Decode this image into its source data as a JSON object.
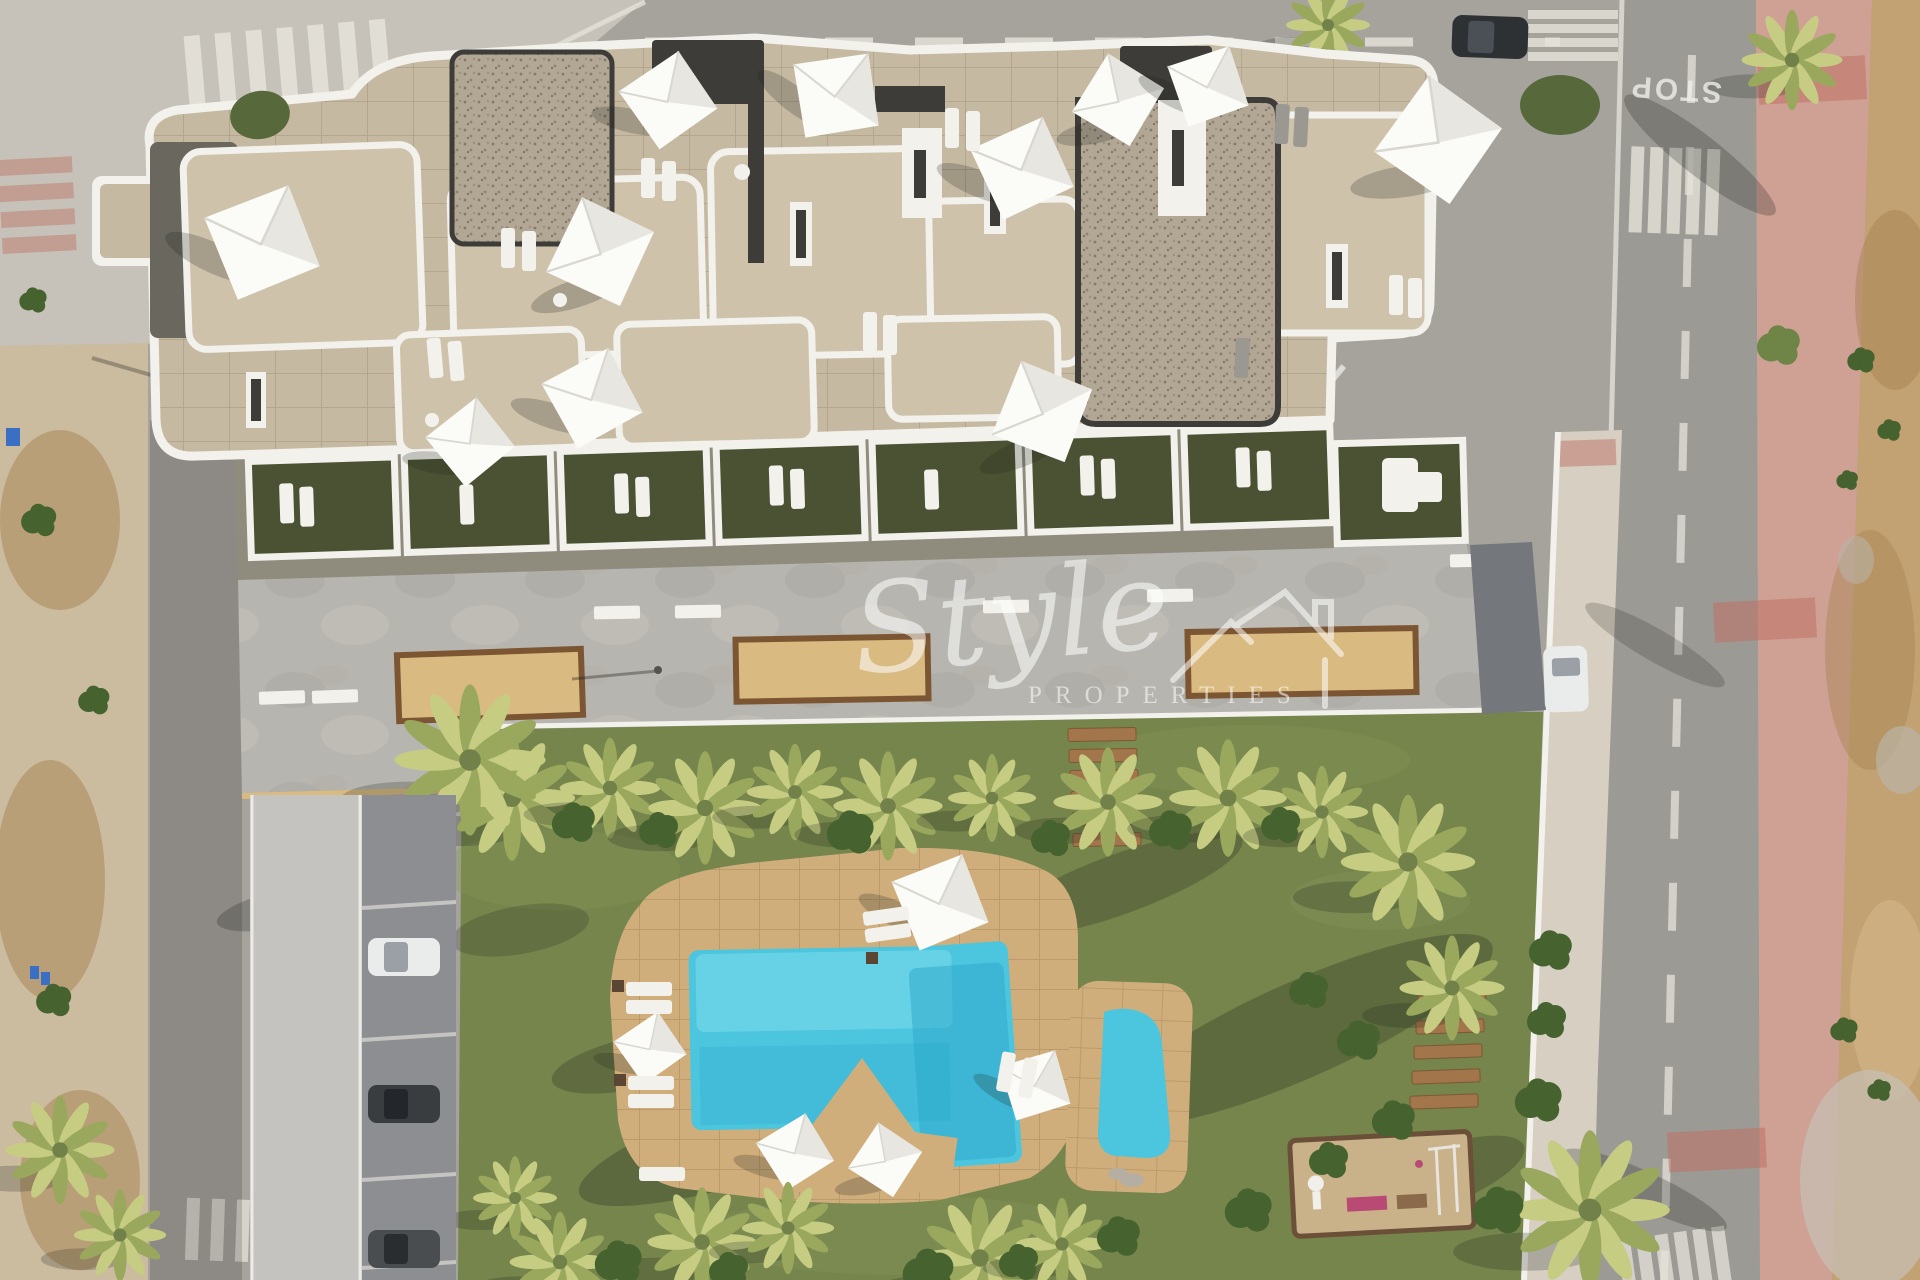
{
  "watermark": {
    "brand_script": "Style",
    "brand_caps": "PROPERTIES"
  },
  "roads": {
    "stop_marking": "STOP"
  },
  "palette": {
    "road": "#a6a39d",
    "pave": "#c6c2b9",
    "road2": "#9c9a94",
    "walk": "#cbbb9f",
    "pink": "#cfa195",
    "red": "#bf7265",
    "dirt": "#c2a173",
    "dirtd": "#a8844f",
    "lawn": "#75854b",
    "lawnl": "#87975c",
    "gdark": "#4b5233",
    "conc": "#b7b5af",
    "conc2": "#c4c3bf",
    "stone": "#c6b9a2",
    "terr": "#cec2ab",
    "grav": "#b2a794",
    "dark": "#3e3c38",
    "white": "#f2f1ec",
    "psand": "#d9ba80",
    "pbord": "#7c5633",
    "deck": "#cfae7c",
    "water": "#4cc5de",
    "waterl": "#82e0ee",
    "waterd": "#2ba8ca",
    "wood": "#a3754a",
    "sand": "#c9b28a",
    "sandb": "#6b4f38",
    "pink2": "#b84a74",
    "cardark": "#3a3d40",
    "carwhite": "#eaebeb",
    "frond": "#c6cd83",
    "frondd": "#9aa85e",
    "hedge": "#57683a",
    "bush": "#45622f",
    "mark": "#e6e3db"
  }
}
